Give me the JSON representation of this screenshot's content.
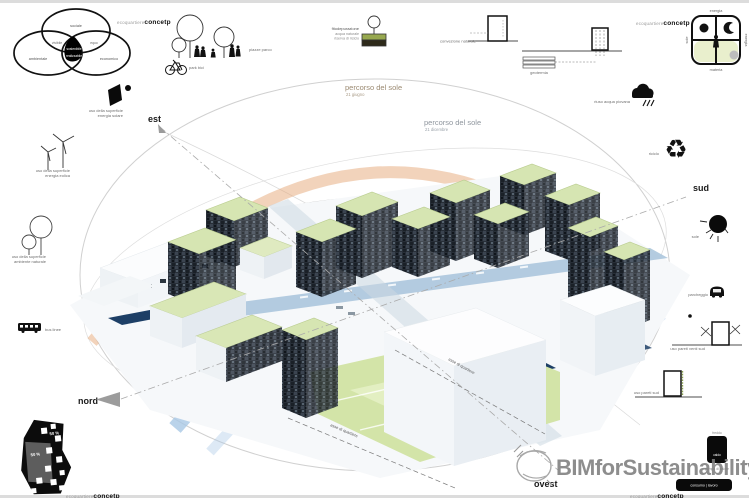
{
  "brand": {
    "light": "ecoquartiere",
    "bold": "concetp"
  },
  "venn": {
    "top": "sociale",
    "left": "ambientale",
    "right": "economico",
    "overlap_top_left": "vivibile",
    "overlap_top_right": "equo",
    "center": "sostenibile",
    "center_sub": "realizzabile"
  },
  "park": {
    "label": "piazze parco",
    "bike_label": "park bici"
  },
  "fito": {
    "title": "fitodepurazione",
    "sub1": "acqua naturale",
    "sub2": "riserva di riciclo"
  },
  "sections": {
    "convezione": "convezione naturale",
    "geotermia": "geotermia"
  },
  "concept_grid": {
    "top": "energia",
    "right": "energia",
    "bottom": "materia",
    "left": "sole"
  },
  "surface_icons": {
    "solare_line1": "uso della superficie",
    "solare_line2": "energia solare",
    "eolica_line1": "uso della superficie",
    "eolica_line2": "energia eolica",
    "natura_line1": "uso della superficie",
    "natura_line2": "ambiente naturale",
    "bus": "bus linee"
  },
  "right_icons": {
    "pioggia": "riuso acqua piovana",
    "riciclo": "riciclo",
    "sole": "sole",
    "parcheggio": "parcheggio",
    "pareti_venti": "uso pareti venti sud",
    "pareti_sud": "uso pareti sud",
    "pompa_top": "freddo",
    "pompa_bottom": "caldo",
    "pompa": "pompa di calore",
    "consumo": "consumo | lavoro"
  },
  "compass": {
    "est": "est",
    "nord": "nord",
    "sud": "sud",
    "ovest": "ovest"
  },
  "sun_paths": {
    "summer_title": "percorso del sole",
    "summer_sub": "21 giugno",
    "winter_title": "percorso del sole",
    "winter_sub": "21 dicembre"
  },
  "site_plan": {
    "pct_left": "50 %",
    "pct_right": "50 %"
  },
  "axes": {
    "label1": "asse di quartiere",
    "label2": "asse di quartiere"
  },
  "watermark": {
    "text": "BIMforSustainability"
  },
  "icons": {
    "recycle_glyph": "♻"
  },
  "colors": {
    "summer_arc": "#e5a877",
    "winter_arc": "#a9c8e5",
    "facade": "#272e37",
    "roof": "#d6e5b2",
    "lawn": "#d3e4a8",
    "water": "#1d3f66",
    "road": "#a7c3da",
    "edge": "#dcdcdc"
  }
}
